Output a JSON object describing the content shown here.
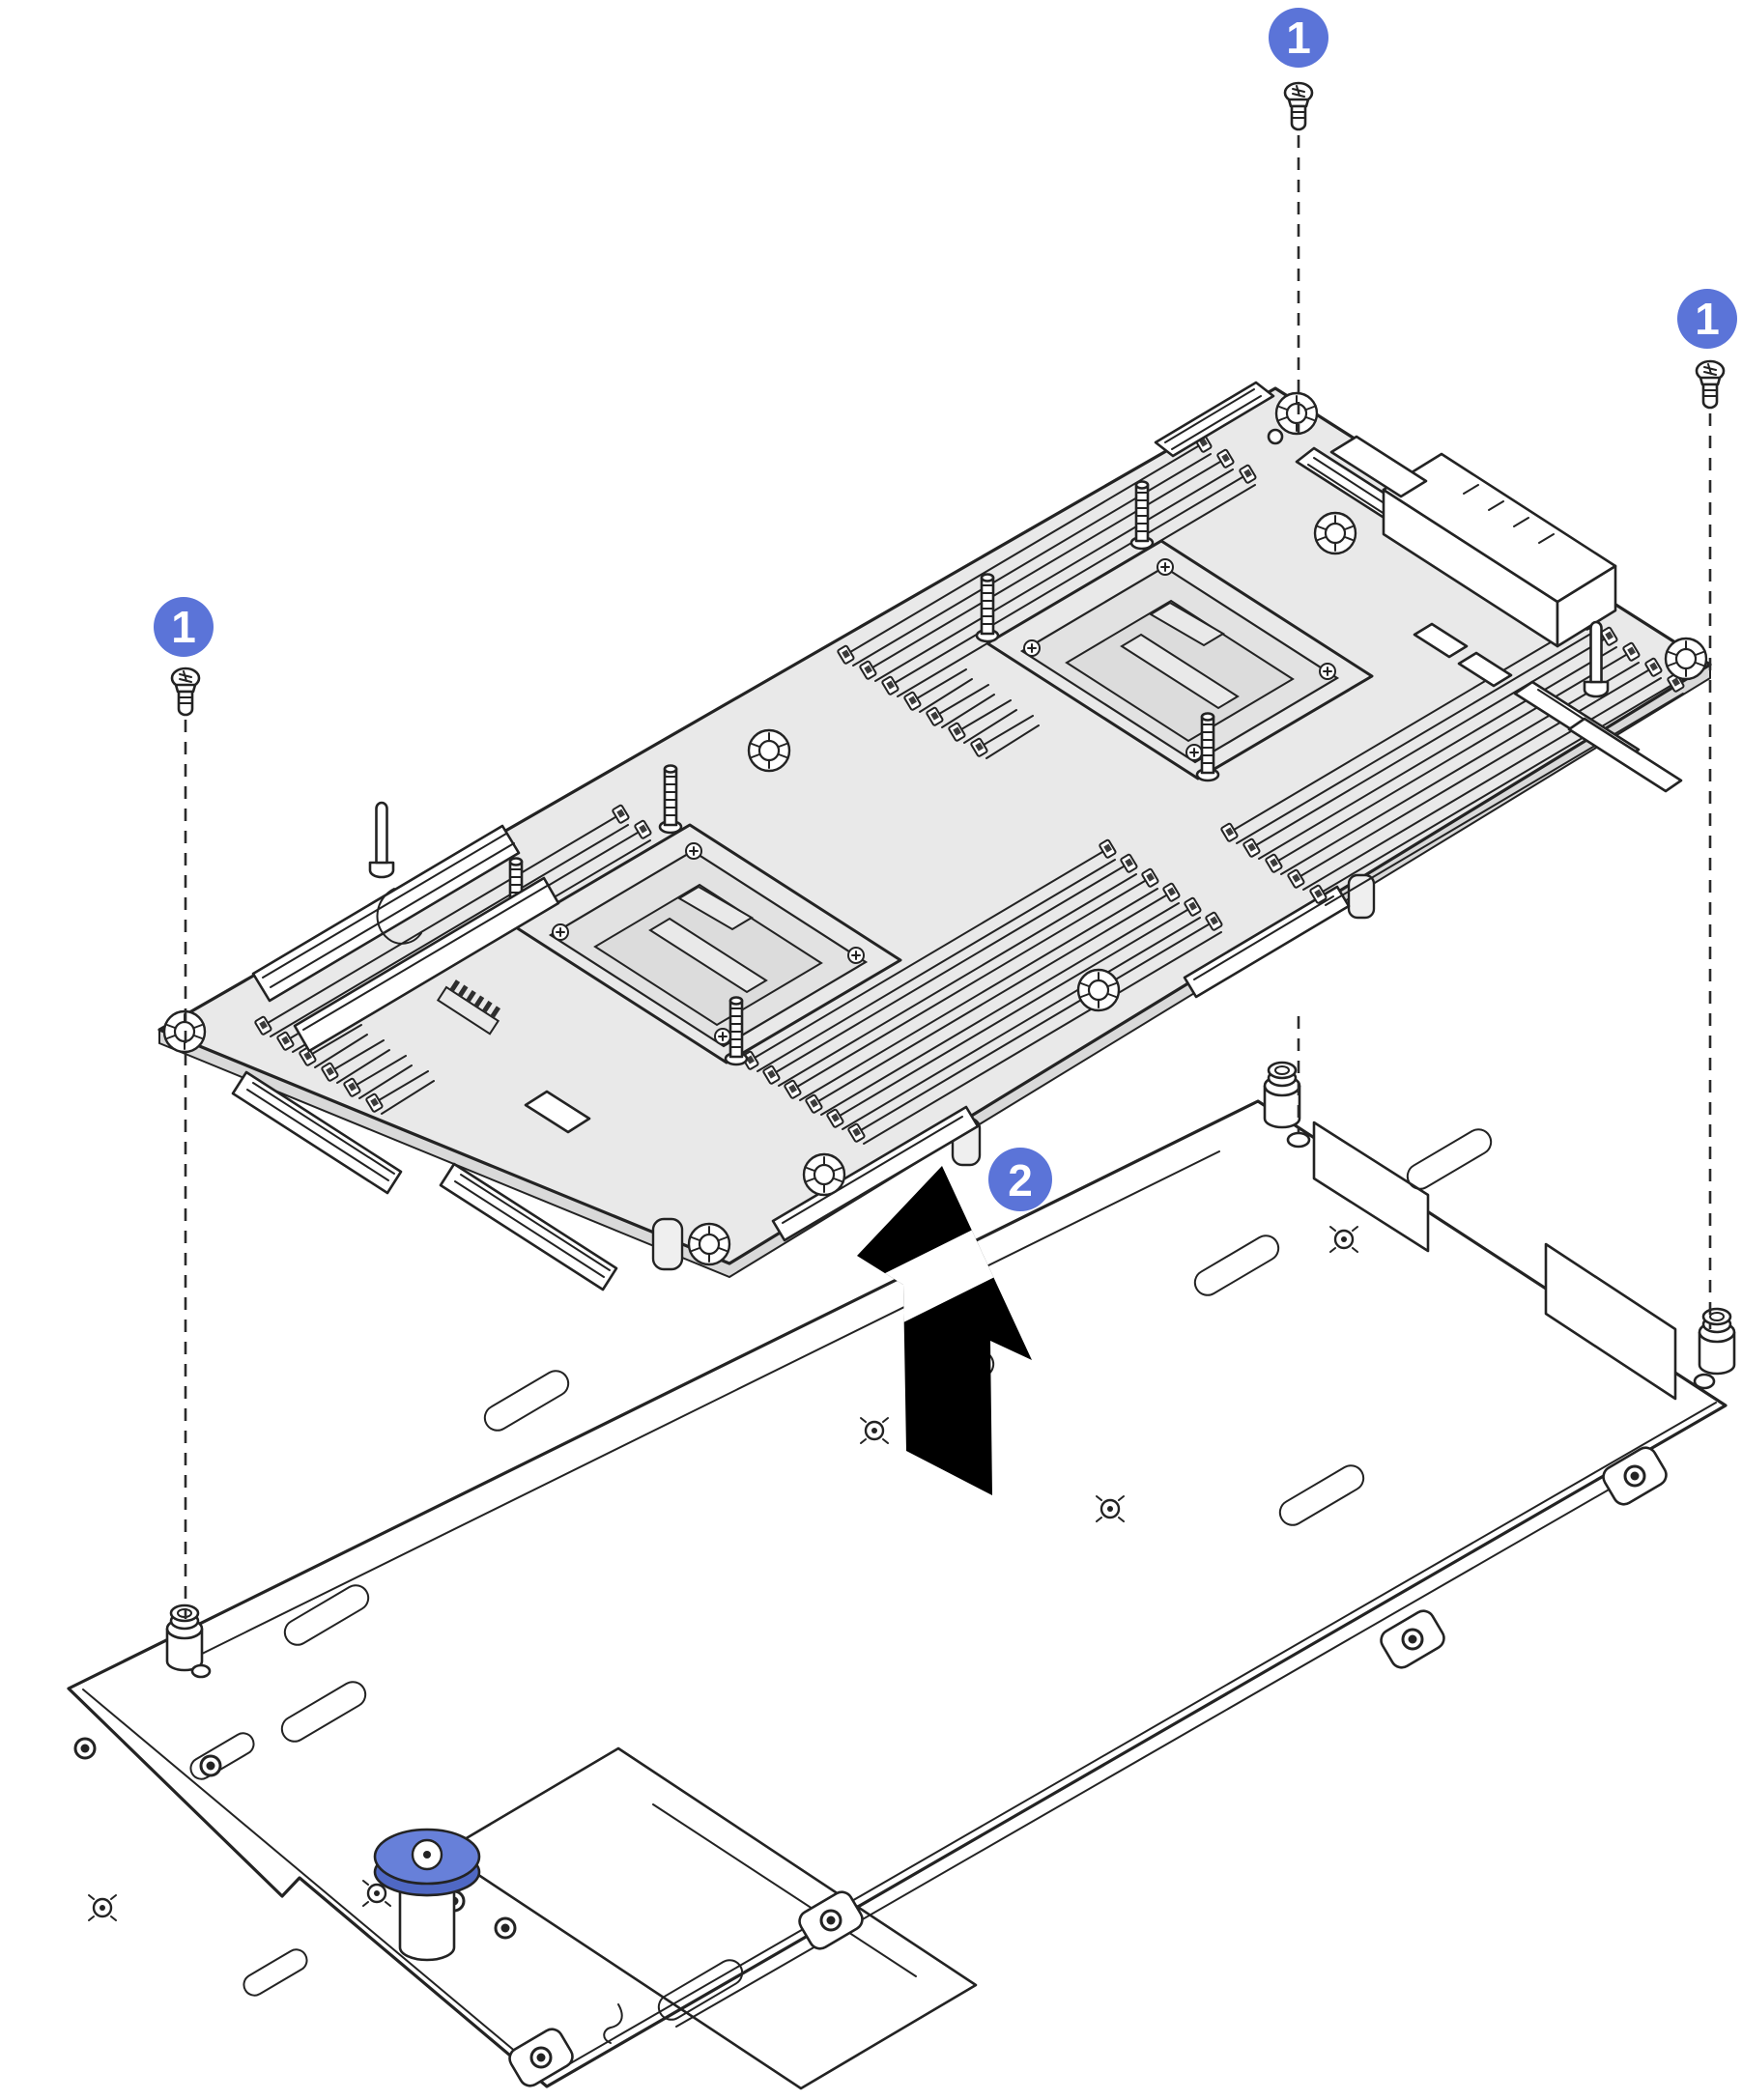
{
  "diagram": {
    "callouts": [
      {
        "id": "step1-top",
        "label": "1"
      },
      {
        "id": "step1-right",
        "label": "1"
      },
      {
        "id": "step1-left",
        "label": "1"
      },
      {
        "id": "step2-lift",
        "label": "2"
      }
    ],
    "icons": {
      "screw": "screw-icon",
      "lift_arrow": "arrow-up-icon",
      "plunger": "plunger-knob-icon",
      "standoff": "standoff-post-icon"
    },
    "colors": {
      "callout_fill": "#5b74d8",
      "callout_text": "#ffffff",
      "outline": "#232323",
      "board_fill": "#e9e9e9",
      "board_side_fill": "#d9d9d9",
      "socket_plate_fill": "#dcdcdc",
      "tray_fill": "#ffffff",
      "arrow_fill": "#000000",
      "plunger_cap_fill": "#6780d9",
      "plunger_cap_rim": "#4f68c4"
    }
  }
}
